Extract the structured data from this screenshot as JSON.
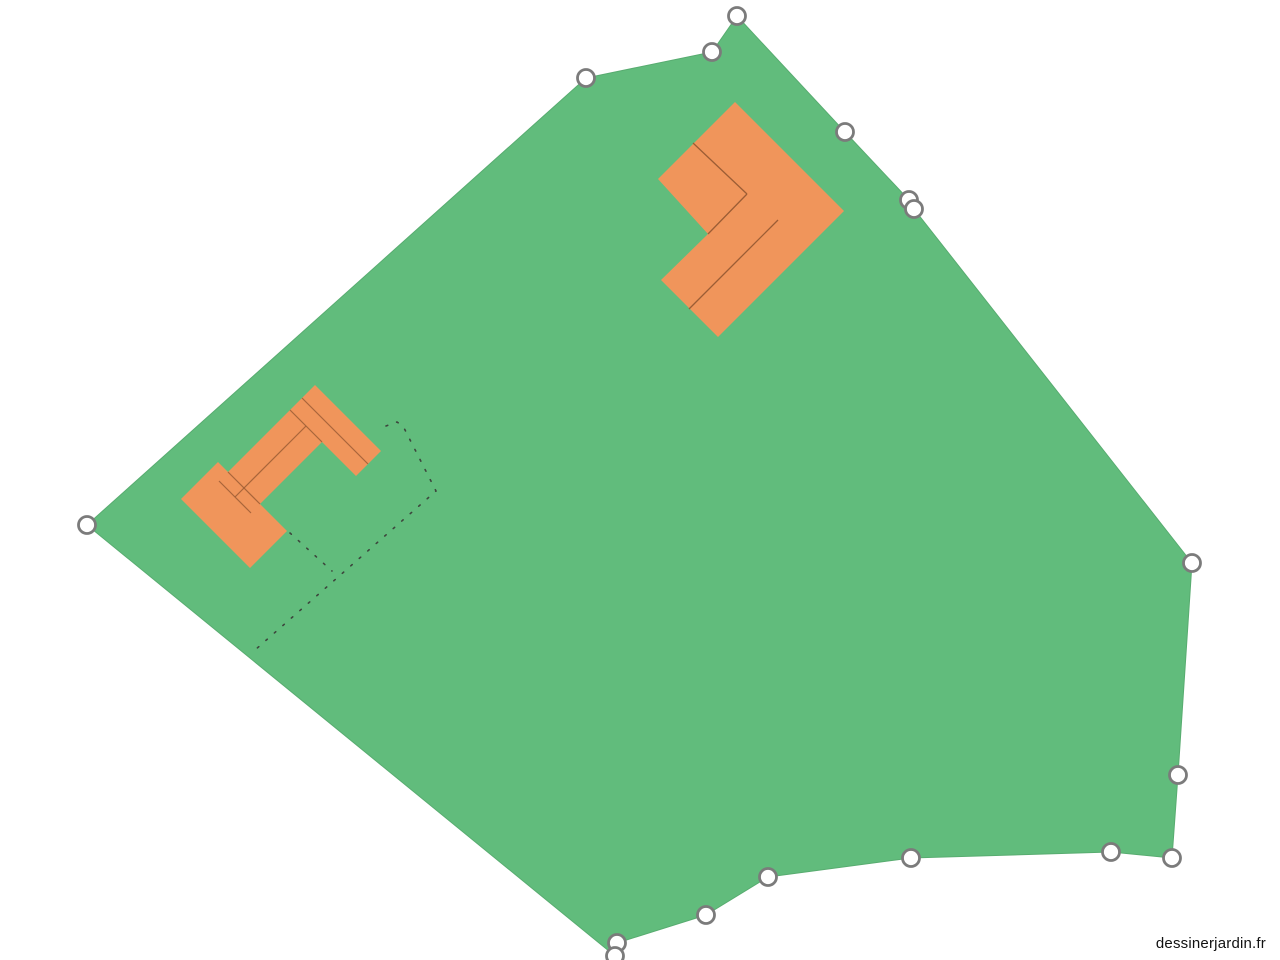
{
  "watermark": {
    "label": "dessinerjardin.fr"
  },
  "canvas": {
    "width": 1280,
    "height": 960,
    "background": "#ffffff"
  },
  "colors": {
    "parcel_fill": "#61bc7c",
    "parcel_edge": "#58ac70",
    "building_fill": "#f0955b",
    "building_seam": "#9c5d35",
    "handle_fill": "#ffffff",
    "handle_stroke": "#7b7b7b",
    "dotted_line": "#3d463d",
    "watermark_text": "#111111"
  },
  "parcel": {
    "points": [
      [
        737,
        16
      ],
      [
        845,
        132
      ],
      [
        909,
        200
      ],
      [
        914,
        209
      ],
      [
        1192,
        563
      ],
      [
        1178,
        775
      ],
      [
        1172,
        858
      ],
      [
        1111,
        852
      ],
      [
        911,
        858
      ],
      [
        768,
        877
      ],
      [
        706,
        915
      ],
      [
        617,
        943
      ],
      [
        615,
        956
      ],
      [
        87,
        525
      ],
      [
        586,
        78
      ],
      [
        712,
        52
      ]
    ]
  },
  "handles": {
    "radius": 8.5,
    "stroke_width": 2.8,
    "positions": [
      [
        737,
        16
      ],
      [
        845,
        132
      ],
      [
        909,
        200
      ],
      [
        914,
        209
      ],
      [
        1192,
        563
      ],
      [
        1178,
        775
      ],
      [
        1172,
        858
      ],
      [
        1111,
        852
      ],
      [
        911,
        858
      ],
      [
        768,
        877
      ],
      [
        706,
        915
      ],
      [
        617,
        943
      ],
      [
        615,
        956
      ],
      [
        87,
        525
      ],
      [
        586,
        78
      ],
      [
        712,
        52
      ]
    ]
  },
  "buildings": {
    "main": {
      "outline": [
        [
          735,
          102
        ],
        [
          844,
          211
        ],
        [
          718,
          337
        ],
        [
          661,
          280
        ],
        [
          708,
          234
        ],
        [
          658,
          179
        ]
      ],
      "seams": [
        [
          [
            693,
            143
          ],
          [
            747,
            194
          ]
        ],
        [
          [
            747,
            194
          ],
          [
            708,
            234
          ]
        ],
        [
          [
            778,
            220
          ],
          [
            689,
            309
          ]
        ]
      ]
    },
    "annex": {
      "rects": [
        [
          [
            315,
            385
          ],
          [
            381,
            451
          ],
          [
            356,
            476
          ],
          [
            290,
            410
          ]
        ],
        [
          [
            290,
            410
          ],
          [
            322,
            442
          ],
          [
            251,
            513
          ],
          [
            219,
            481
          ]
        ],
        [
          [
            218,
            462
          ],
          [
            287,
            531
          ],
          [
            250,
            568
          ],
          [
            181,
            499
          ]
        ]
      ],
      "seams": [
        [
          [
            302,
            398
          ],
          [
            368,
            464
          ]
        ],
        [
          [
            290,
            410
          ],
          [
            322,
            442
          ]
        ],
        [
          [
            306,
            426
          ],
          [
            235,
            497
          ]
        ],
        [
          [
            219,
            481
          ],
          [
            251,
            513
          ]
        ],
        [
          [
            228,
            472
          ],
          [
            260,
            504
          ]
        ]
      ]
    }
  },
  "dotted_outlines": [
    [
      [
        386,
        426
      ],
      [
        397,
        422
      ],
      [
        403,
        426
      ],
      [
        436,
        491
      ],
      [
        255,
        650
      ]
    ],
    [
      [
        290,
        533
      ],
      [
        332,
        571
      ]
    ]
  ]
}
